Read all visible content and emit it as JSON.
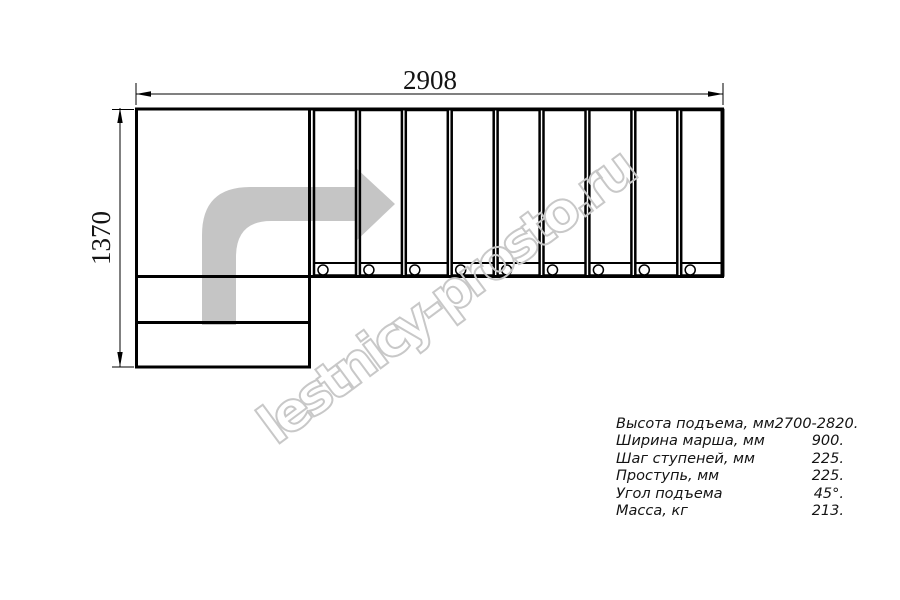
{
  "drawing": {
    "dimensions": {
      "total_length": "2908",
      "total_width": "1370"
    },
    "plan": {
      "flight_steps": 9,
      "landing_rows": 2
    },
    "colors": {
      "line": "#000000",
      "arrow_fill": "#c5c5c5",
      "watermark_stroke": "#c8c8c8",
      "text": "#141414"
    }
  },
  "watermark": {
    "text": "lestnicy-prosto.ru"
  },
  "spec_table": {
    "rows": [
      {
        "label": "Высота подъема, мм",
        "value": "2700-2820."
      },
      {
        "label": "Ширина марша, мм",
        "value": "900."
      },
      {
        "label": "Шаг ступеней, мм",
        "value": "225."
      },
      {
        "label": "Проступь, мм",
        "value": "225."
      },
      {
        "label": "Угол подъема",
        "value": "45°."
      },
      {
        "label": "Масса, кг",
        "value": "213."
      }
    ]
  }
}
